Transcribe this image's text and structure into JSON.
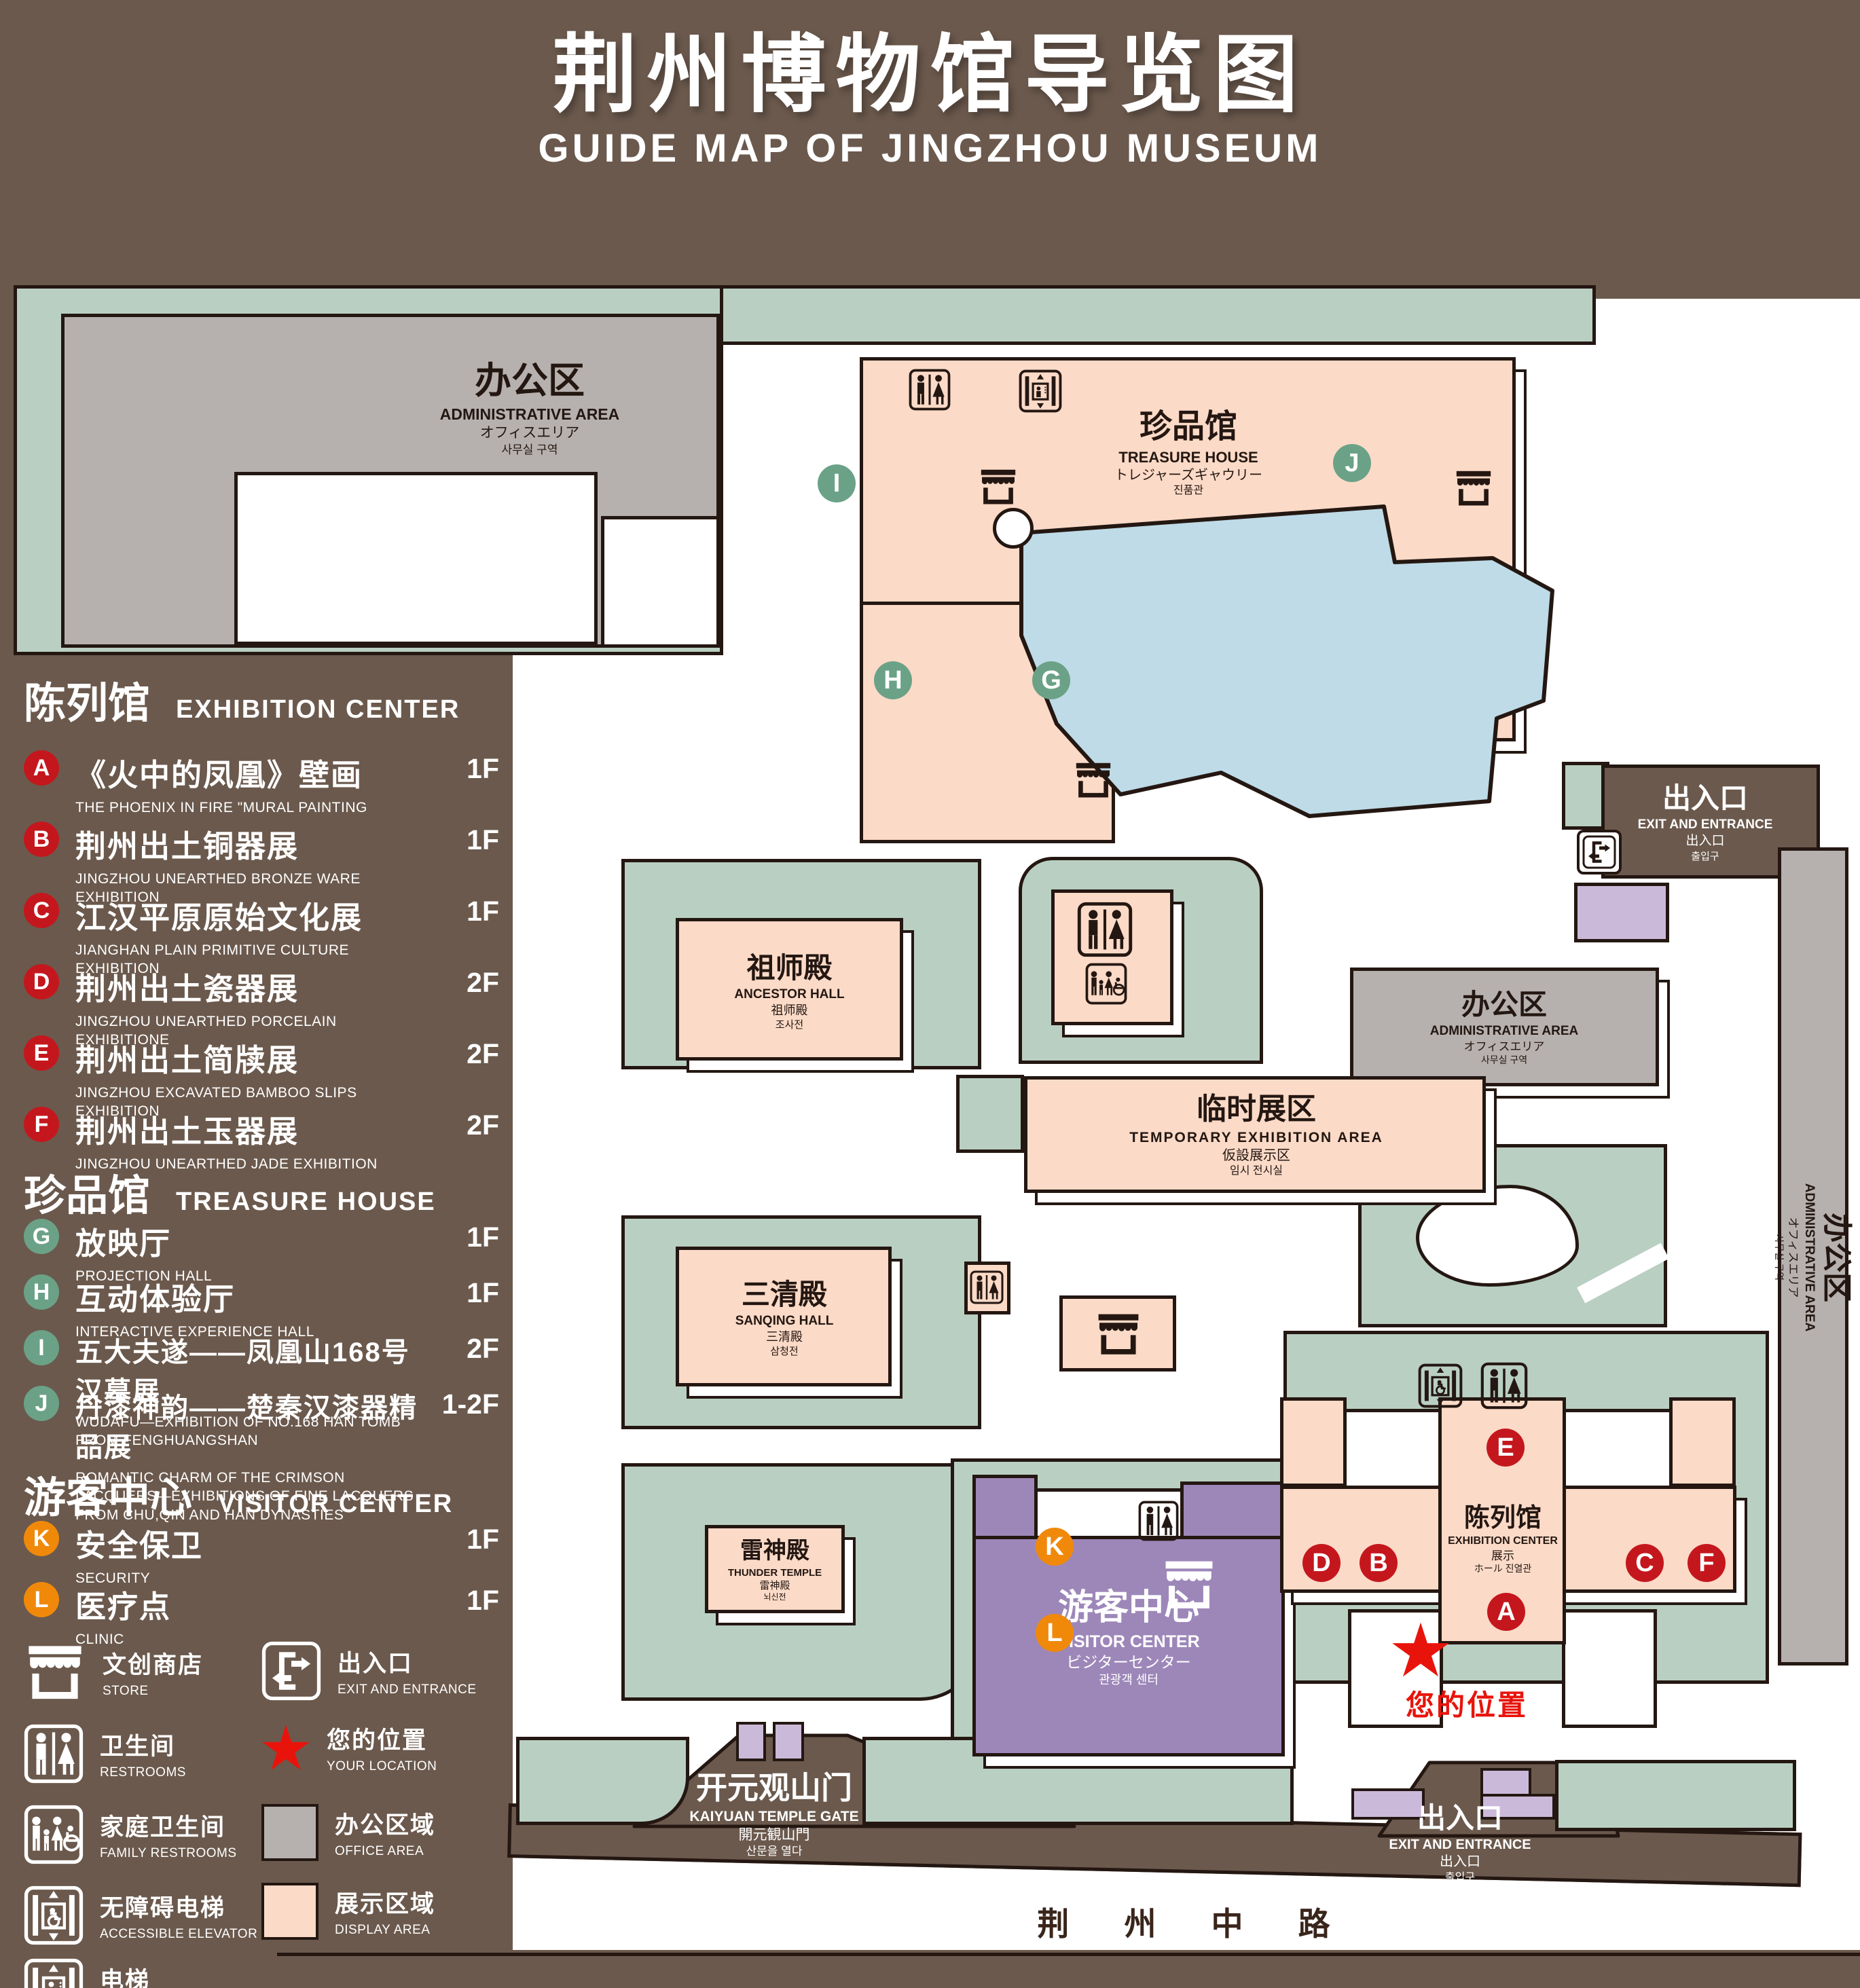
{
  "title": {
    "cn": "荆州博物馆导览图",
    "en": "GUIDE MAP OF JINGZHOU MUSEUM"
  },
  "legend": {
    "sections": [
      {
        "title_cn": "陈列馆",
        "title_en": "EXHIBITION CENTER",
        "items": [
          {
            "letter": "A",
            "cn": "《火中的凤凰》壁画",
            "en": "THE PHOENIX IN FIRE \"MURAL PAINTING",
            "floor": "1F"
          },
          {
            "letter": "B",
            "cn": "荆州出土铜器展",
            "en": "JINGZHOU UNEARTHED BRONZE WARE EXHIBITION",
            "floor": "1F"
          },
          {
            "letter": "C",
            "cn": "江汉平原原始文化展",
            "en": "JIANGHAN PLAIN PRIMITIVE CULTURE EXHIBITION",
            "floor": "1F"
          },
          {
            "letter": "D",
            "cn": "荆州出土瓷器展",
            "en": "JINGZHOU UNEARTHED PORCELAIN EXHIBITIONE",
            "floor": "2F"
          },
          {
            "letter": "E",
            "cn": "荆州出土简牍展",
            "en": "JINGZHOU EXCAVATED BAMBOO SLIPS EXHIBITION",
            "floor": "2F"
          },
          {
            "letter": "F",
            "cn": "荆州出土玉器展",
            "en": "JINGZHOU UNEARTHED JADE EXHIBITION",
            "floor": "2F"
          }
        ]
      },
      {
        "title_cn": "珍品馆",
        "title_en": "TREASURE HOUSE",
        "items": [
          {
            "letter": "G",
            "cn": "放映厅",
            "en": "PROJECTION HALL",
            "floor": "1F"
          },
          {
            "letter": "H",
            "cn": "互动体验厅",
            "en": "INTERACTIVE EXPERIENCE HALL",
            "floor": "1F"
          },
          {
            "letter": "I",
            "cn": "五大夫遂——凤凰山168号汉墓展",
            "en": "WUDAFU—EXHIBITION OF NO.168 HAN TOMB FROM FENGHUANGSHAN",
            "floor": "2F"
          },
          {
            "letter": "J",
            "cn": "丹漆神韵——楚秦汉漆器精品展",
            "en": "ROMANTIC CHARM OF THE CRIMSON LACQUERS—EXHIBITIONS OF FINE LACQUERS FROM CHU,QIN AND HAN DYNASTIES",
            "floor": "1-2F"
          }
        ]
      },
      {
        "title_cn": "游客中心",
        "title_en": "VISITOR CENTER",
        "items": [
          {
            "letter": "K",
            "cn": "安全保卫",
            "en": "SECURITY",
            "floor": "1F"
          },
          {
            "letter": "L",
            "cn": "医疗点",
            "en": "CLINIC",
            "floor": "1F"
          }
        ]
      }
    ],
    "symbols": [
      {
        "icon": "store-icon",
        "cn": "文创商店",
        "en": "STORE"
      },
      {
        "icon": "exit-icon",
        "cn": "出入口",
        "en": "EXIT AND ENTRANCE"
      },
      {
        "icon": "restroom-icon",
        "cn": "卫生间",
        "en": "RESTROOMS"
      },
      {
        "icon": "location-star-icon",
        "cn": "您的位置",
        "en": "YOUR LOCATION"
      },
      {
        "icon": "family-restroom-icon",
        "cn": "家庭卫生间",
        "en": "FAMILY RESTROOMS"
      },
      {
        "icon": "office-area-swatch",
        "cn": "办公区域",
        "en": "OFFICE AREA"
      },
      {
        "icon": "accessible-elevator-icon",
        "cn": "无障碍电梯",
        "en": "ACCESSIBLE ELEVATOR"
      },
      {
        "icon": "display-area-swatch",
        "cn": "展示区域",
        "en": "DISPLAY AREA"
      },
      {
        "icon": "elevator-icon",
        "cn": "电梯",
        "en": "Elevator"
      }
    ]
  },
  "map": {
    "buildings": {
      "admin_top": {
        "l1": "办公区",
        "l2": "ADMINISTRATIVE AREA",
        "l3": "オフィスエリア",
        "l4": "사무실 구역"
      },
      "admin_right": {
        "l1": "办公区",
        "l2": "ADMINISTRATIVE AREA",
        "l3": "オフィスエリア",
        "l4": "사무실 구역"
      },
      "admin_strip": {
        "l1": "办公区",
        "l2": "ADMINISTRATIVE AREA",
        "l3": "オフィスエリア",
        "l4": "사무실 구역"
      },
      "treasure": {
        "l1": "珍品馆",
        "l2": "TREASURE HOUSE",
        "l3": "トレジャーズギャウリー",
        "l4": "진품관"
      },
      "ancestor": {
        "l1": "祖师殿",
        "l2": "ANCESTOR HALL",
        "l3": "祖师殿",
        "l4": "조사전"
      },
      "temporary": {
        "l1": "临时展区",
        "l2": "TEMPORARY EXHIBITION AREA",
        "l3": "仮設展示区",
        "l4": "임시 전시실"
      },
      "sanqing": {
        "l1": "三清殿",
        "l2": "SANQING HALL",
        "l3": "三清殿",
        "l4": "삼청전"
      },
      "thunder": {
        "l1": "雷神殿",
        "l2": "THUNDER TEMPLE",
        "l3": "雷神殿",
        "l4": "뇌신전"
      },
      "exhibition": {
        "l1": "陈列馆",
        "l2": "EXHIBITION CENTER",
        "l3": "展示",
        "l4": "ホール 진열관"
      },
      "visitor": {
        "l1": "游客中心",
        "l2": "VISITOR CENTER",
        "l3": "ビジターセンター",
        "l4": "관광객 센터"
      },
      "gate": {
        "l1": "开元观山门",
        "l2": "KAIYUAN TEMPLE GATE",
        "l3": "開元観山門",
        "l4": "산문을 열다"
      },
      "exit_top": {
        "l1": "出入口",
        "l2": "EXIT AND ENTRANCE",
        "l3": "出入口",
        "l4": "출입구"
      },
      "exit_bottom": {
        "l1": "出入口",
        "l2": "EXIT AND ENTRANCE",
        "l3": "出入口",
        "l4": "출입구"
      }
    },
    "road": "荆 州 中 路",
    "your_location": "您的位置",
    "markers": {
      "a": "A",
      "b": "B",
      "c": "C",
      "d": "D",
      "e": "E",
      "f": "F",
      "g": "G",
      "h": "H",
      "i": "I",
      "j": "J",
      "k": "K",
      "l": "L"
    }
  },
  "colors": {
    "page": "#6b594d",
    "dark": "#241712",
    "lawn": "#b9cfc2",
    "display": "#fbdac7",
    "office": "#b6b1ae",
    "lake": "#bedbe7",
    "purple": "#9d87b9",
    "lavender": "#cbb9da",
    "red": "#c4171d",
    "greenbadge": "#6ba287",
    "orange": "#f0890a",
    "loc": "#e8140b",
    "roadtext": "#3a251b"
  }
}
